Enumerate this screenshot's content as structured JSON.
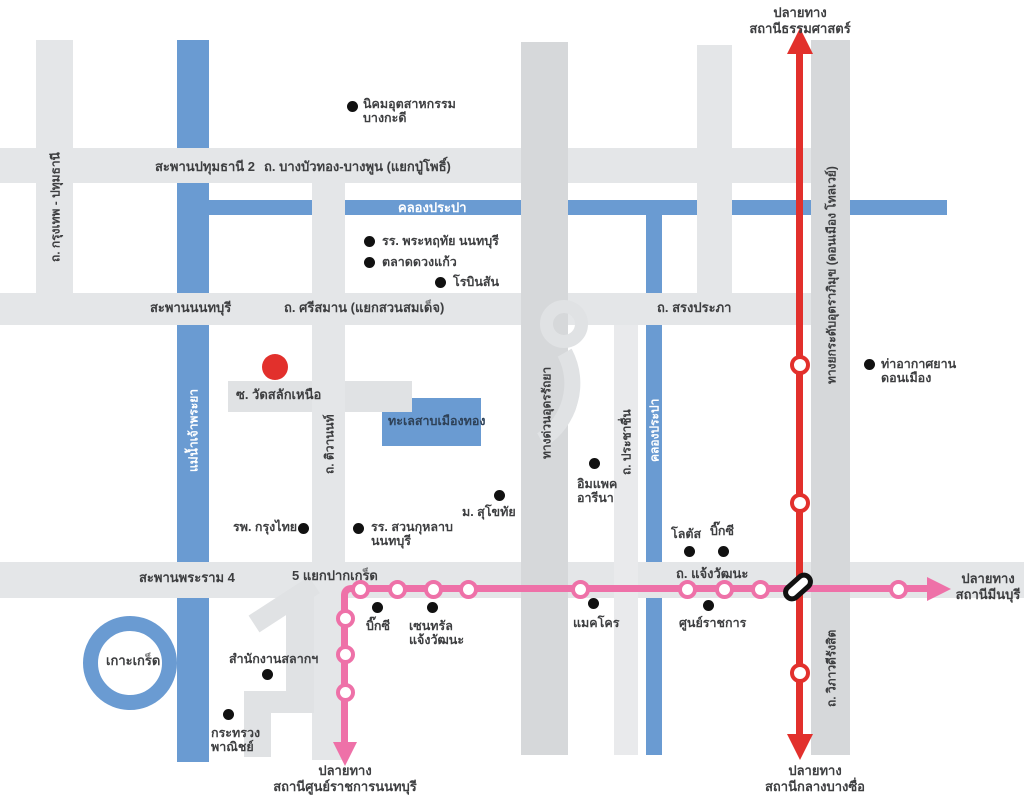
{
  "colors": {
    "water": "#6a9bd2",
    "road": "#e4e6e8",
    "road_dark": "#d6d8da",
    "red_line": "#e2302c",
    "pink_line": "#ee71a8",
    "poi_dot": "#111111",
    "text": "#3d3e40"
  },
  "destinations": {
    "north": {
      "line1": "ปลายทาง",
      "line2": "สถานีธรรมศาสตร์"
    },
    "east": {
      "line1": "ปลายทาง",
      "line2": "สถานีมีนบุรี"
    },
    "south_red": {
      "line1": "ปลายทาง",
      "line2": "สถานีกลางบางซื่อ"
    },
    "south_pink": {
      "line1": "ปลายทาง",
      "line2": "สถานีศูนย์ราชการนนทบุรี"
    }
  },
  "road_labels": [
    {
      "id": "saphan-pathumthani-2",
      "text": "สะพานปทุมธานี 2",
      "x": 155,
      "y": 159
    },
    {
      "id": "bangbuathong-bangpun",
      "text": "ถ. บางบัวทอง-บางพูน (แยกปู่โพธิ์)",
      "x": 264,
      "y": 159
    },
    {
      "id": "khlong-prapa-horizontal",
      "text": "คลองประปา",
      "x": 398,
      "y": 200,
      "white": true
    },
    {
      "id": "saphan-nonthaburi",
      "text": "สะพานนนทบุรี",
      "x": 150,
      "y": 300
    },
    {
      "id": "srisaman",
      "text": "ถ. ศรีสมาน (แยกสวนสมเด็จ)",
      "x": 284,
      "y": 300
    },
    {
      "id": "songprapha",
      "text": "ถ. สรงประภา",
      "x": 657,
      "y": 300
    },
    {
      "id": "wat-salak-nuea",
      "text": "ซ. วัดสลักเหนือ",
      "x": 236,
      "y": 387
    },
    {
      "id": "saphan-rama-4",
      "text": "สะพานพระราม 4",
      "x": 139,
      "y": 570
    },
    {
      "id": "5-yaek-pakkret",
      "text": "5 แยกปากเกร็ด",
      "x": 292,
      "y": 568
    },
    {
      "id": "chaengwattana",
      "text": "ถ. แจ้งวัฒนะ",
      "x": 676,
      "y": 566
    },
    {
      "id": "koh-kret",
      "text": "เกาะเกร็ด",
      "x": 106,
      "y": 653
    },
    {
      "id": "mueang-thong-lake",
      "text": "ทะเลสาบเมืองทอง",
      "x": 388,
      "y": 414,
      "lake": true
    }
  ],
  "road_labels_vertical": [
    {
      "id": "krungthep-pathumthani",
      "text": "ถ. กรุงเทพ - ปทุมธานี",
      "x": 55,
      "y": 207,
      "h": 140
    },
    {
      "id": "chao-phraya-river",
      "text": "แม่น้ำเจ้าพระยา",
      "x": 193,
      "y": 430,
      "h": 105,
      "white": true
    },
    {
      "id": "tiwanon",
      "text": "ถ. ติวานนท์",
      "x": 329,
      "y": 444,
      "h": 75
    },
    {
      "id": "udon-ratthaya-expressway",
      "text": "ทางด่วนอุดรรัถยา",
      "x": 546,
      "y": 412,
      "h": 115
    },
    {
      "id": "prachachuen",
      "text": "ถ. ประชาชื่น",
      "x": 626,
      "y": 442,
      "h": 75
    },
    {
      "id": "khlong-prapa-vertical",
      "text": "คลองประปา",
      "x": 654,
      "y": 430,
      "h": 100,
      "white": true
    },
    {
      "id": "don-mueang-tollway",
      "text": "ทางยกระดับอุตราภิมุข (ดอนเมือง โทลเวย์)",
      "x": 831,
      "y": 275,
      "h": 290
    },
    {
      "id": "vibhavadi-rangsit",
      "text": "ถ. วิภาวดีรังสิต",
      "x": 831,
      "y": 668,
      "h": 90
    }
  ],
  "pois": [
    {
      "id": "bangkadi-industrial-estate",
      "dot": [
        352,
        106
      ],
      "label": [
        363,
        97
      ],
      "lines": [
        "นิคมอุตสาหกรรม",
        "บางกะดี"
      ]
    },
    {
      "id": "phraharuethai-school",
      "dot": [
        369,
        241
      ],
      "label": [
        382,
        234
      ],
      "lines": [
        "รร. พระหฤทัย นนทบุรี"
      ]
    },
    {
      "id": "duangkaew-market",
      "dot": [
        369,
        262
      ],
      "label": [
        382,
        255
      ],
      "lines": [
        "ตลาดดวงแก้ว"
      ]
    },
    {
      "id": "robinson",
      "dot": [
        440,
        282
      ],
      "label": [
        453,
        275
      ],
      "lines": [
        "โรบินสัน"
      ]
    },
    {
      "id": "impact-arena",
      "dot": [
        594,
        463
      ],
      "label": [
        577,
        477
      ],
      "lines": [
        "อิมแพค",
        "อารีนา"
      ]
    },
    {
      "id": "sukhothai-university",
      "dot": [
        499,
        495
      ],
      "label": [
        462,
        505
      ],
      "lines": [
        "ม. สุโขทัย"
      ]
    },
    {
      "id": "krungthai-hospital",
      "dot": [
        303,
        528
      ],
      "label": [
        233,
        520
      ],
      "lines": [
        "รพ. กรุงไทย"
      ]
    },
    {
      "id": "suankularb-school",
      "dot": [
        358,
        528
      ],
      "label": [
        371,
        520
      ],
      "lines": [
        "รร. สวนกุหลาบ",
        "นนทบุรี"
      ]
    },
    {
      "id": "don-mueang-airport",
      "dot": [
        869,
        364
      ],
      "label": [
        881,
        357
      ],
      "lines": [
        "ท่าอากาศยาน",
        "ดอนเมือง"
      ]
    },
    {
      "id": "lotus",
      "dot": [
        689,
        551
      ],
      "label": [
        671,
        527
      ],
      "lines": [
        "โลตัส"
      ]
    },
    {
      "id": "big-c-north",
      "dot": [
        723,
        551
      ],
      "label": [
        710,
        524
      ],
      "lines": [
        "บิ๊กซี"
      ]
    },
    {
      "id": "big-c-chaengwattana",
      "dot": [
        377,
        607
      ],
      "label": [
        366,
        619
      ],
      "lines": [
        "บิ๊กซี"
      ]
    },
    {
      "id": "central-chaengwattana",
      "dot": [
        432,
        607
      ],
      "label": [
        409,
        619
      ],
      "lines": [
        "เซนทรัล",
        "แจ้งวัฒนะ"
      ]
    },
    {
      "id": "makro",
      "dot": [
        593,
        603
      ],
      "label": [
        573,
        616
      ],
      "lines": [
        "แมคโคร"
      ]
    },
    {
      "id": "government-complex",
      "dot": [
        708,
        605
      ],
      "label": [
        679,
        616
      ],
      "lines": [
        "ศูนย์ราชการ"
      ]
    },
    {
      "id": "lottery-office",
      "dot": [
        267,
        674
      ],
      "label": [
        229,
        652
      ],
      "lines": [
        "สำนักงานสลากฯ"
      ]
    },
    {
      "id": "ministry-of-commerce",
      "dot": [
        228,
        714
      ],
      "label": [
        211,
        726
      ],
      "lines": [
        "กระทรวง",
        "พาณิชย์"
      ]
    }
  ],
  "red_marker": {
    "x": 275,
    "y": 367
  },
  "transit": {
    "red_line_stations": [
      {
        "x": 800,
        "y": 365
      },
      {
        "x": 800,
        "y": 503
      },
      {
        "x": 800,
        "y": 673
      }
    ],
    "interchange": {
      "x": 798,
      "y": 587
    },
    "pink_line_stations": [
      {
        "x": 360,
        "y": 589
      },
      {
        "x": 397,
        "y": 589
      },
      {
        "x": 433,
        "y": 589
      },
      {
        "x": 468,
        "y": 589
      },
      {
        "x": 580,
        "y": 589
      },
      {
        "x": 687,
        "y": 589
      },
      {
        "x": 724,
        "y": 589
      },
      {
        "x": 760,
        "y": 589
      },
      {
        "x": 898,
        "y": 589
      },
      {
        "x": 345,
        "y": 618
      },
      {
        "x": 345,
        "y": 654
      },
      {
        "x": 345,
        "y": 692
      }
    ]
  }
}
